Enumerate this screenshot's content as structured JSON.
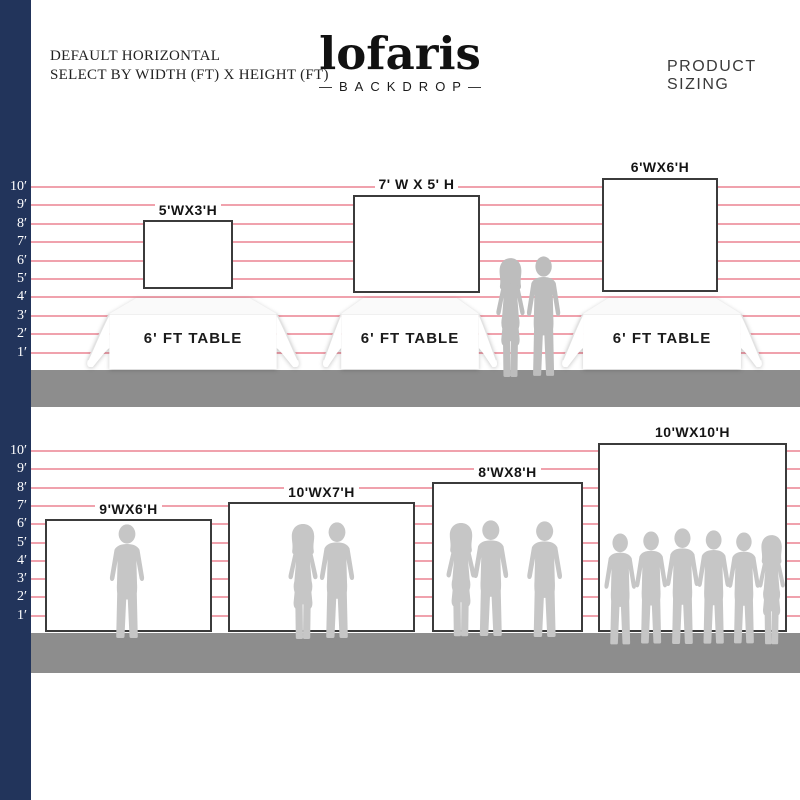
{
  "header": {
    "title_line1": "DEFAULT HORIZONTAL",
    "title_line2": "SELECT BY WIDTH (FT) X HEIGHT (FT)",
    "brand": "lofaris",
    "brand_sub": "—BACKDROP—",
    "product_sizing": "PRODUCT SIZING"
  },
  "ruler": {
    "labels": [
      "10′",
      "9′",
      "8′",
      "7′",
      "6′",
      "5′",
      "4′",
      "3′",
      "2′",
      "1′"
    ]
  },
  "scene1": {
    "backdrops": [
      {
        "label": "5'WX3'H",
        "width_ft": 5,
        "height_ft": 3
      },
      {
        "label": "7' W X 5' H",
        "width_ft": 7,
        "height_ft": 5
      },
      {
        "label": "6'WX6'H",
        "width_ft": 6,
        "height_ft": 6
      }
    ],
    "table_label": "6' FT TABLE"
  },
  "scene2": {
    "backdrops": [
      {
        "label": "9'WX6'H",
        "width_ft": 9,
        "height_ft": 6
      },
      {
        "label": "10'WX7'H",
        "width_ft": 10,
        "height_ft": 7
      },
      {
        "label": "8'WX8'H",
        "width_ft": 8,
        "height_ft": 8
      },
      {
        "label": "10'WX10'H",
        "width_ft": 10,
        "height_ft": 10
      }
    ]
  },
  "colors": {
    "navy": "#22345b",
    "grid_line": "#f0a2ad",
    "floor": "#8d8d8d",
    "silhouette_row1": "#bdbdbd",
    "silhouette_row2": "#c6c6c6",
    "backdrop_border": "#3b3b3b"
  }
}
